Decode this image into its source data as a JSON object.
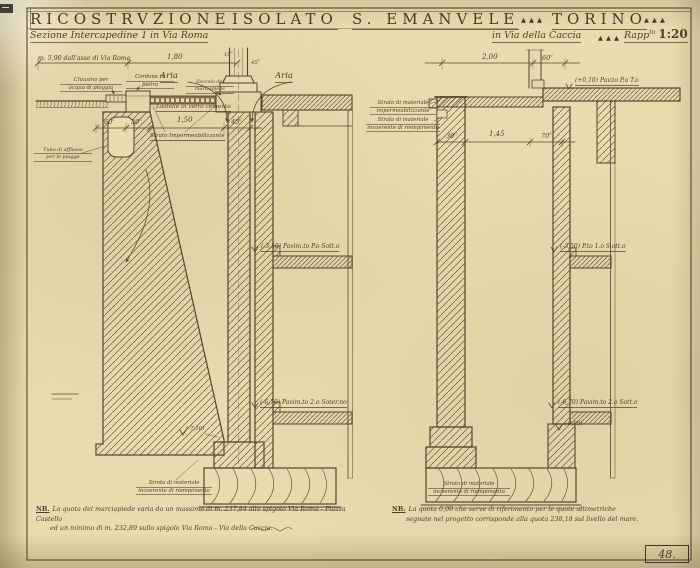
{
  "colors": {
    "paper": "#e8dcae",
    "ink": "#4e3f28",
    "line": "#55452e",
    "hatch": "#6e5c40"
  },
  "units": {
    "c": "c"
  },
  "title": {
    "word1": "RICOSTRVZIONE",
    "word2": "ISOLATO",
    "word3": "S. EMANVELE",
    "tri": "▲▲▲",
    "city": "TORINO",
    "subtitle_left": "Sezione Intercapedine 1 in Via Roma",
    "subtitle_right": "in Via della Caccia",
    "scale_word": "Rapp",
    "scale_sup": "to",
    "scale_value": "1:20"
  },
  "left": {
    "dim_offset": "m. 5,90 dall'asse di Via Roma",
    "dim_width": "1,80",
    "dim_col_a": "15",
    "dim_col_b": "45",
    "aria_left": "Aria",
    "aria_right": "Aria",
    "chiusino1": "Chiusino per",
    "chiusino2": "acqua di pioggia",
    "cordone1": "Cordone in",
    "cordone2": "pietra",
    "zoccolo1": "Zoccolo del",
    "zoccolo2": "marciapiede",
    "lastelle": "Lastelle in vetro cemento",
    "strato_imp": "Strato Impermeabilizzante",
    "tubo1": "Tubo di afflusso",
    "tubo2": "per le piogge",
    "dim_60": "60",
    "dim_30": "30",
    "dim_150": "1,50",
    "dim_45": "45",
    "level1": "(-3,50) Pavim.to P.o Sott.o",
    "level2": "(-6,70) Pavim.to 2.o Soter.no",
    "level3": "(-7,10)",
    "fill1": "Strato di materiale",
    "fill2": "incoerente di riempimento"
  },
  "right": {
    "dim_200": "2,00",
    "dim_60": "60",
    "pav_terreno": "(+0,10) Pav.to P.o T.o",
    "imp1": "Strato di materiale",
    "imp2": "impermeabilizzante",
    "inc1": "Strato di materiale",
    "inc2": "incoerente di riempimento",
    "dim_30": "30",
    "dim_145": "1,45",
    "dim_70": "70",
    "level1": "(-3,50) P.to 1.o S.ott.o",
    "level2": "(-6,70) Pavim.to 2.o Sott.o",
    "level3": "(-6,95)",
    "fill1": "Strato di materiale",
    "fill2": "incoerente di riempimento"
  },
  "notes": {
    "nb": "NB.",
    "left1": "La quota del marciapiede varia da un massimo di m. 237,84 allo spigolo Via Roma - Piazza Castello",
    "left2": "ed un minimo di m. 232,89 sullo spigolo Via Roma - Via della Caccia.",
    "right1": "La quota 0,00 che serve di riferimento per le quote altimetriche",
    "right2": "segnate nel progetto corrisponde alla quota 238,18 sul livello del mare.",
    "sheet_number": "48."
  }
}
